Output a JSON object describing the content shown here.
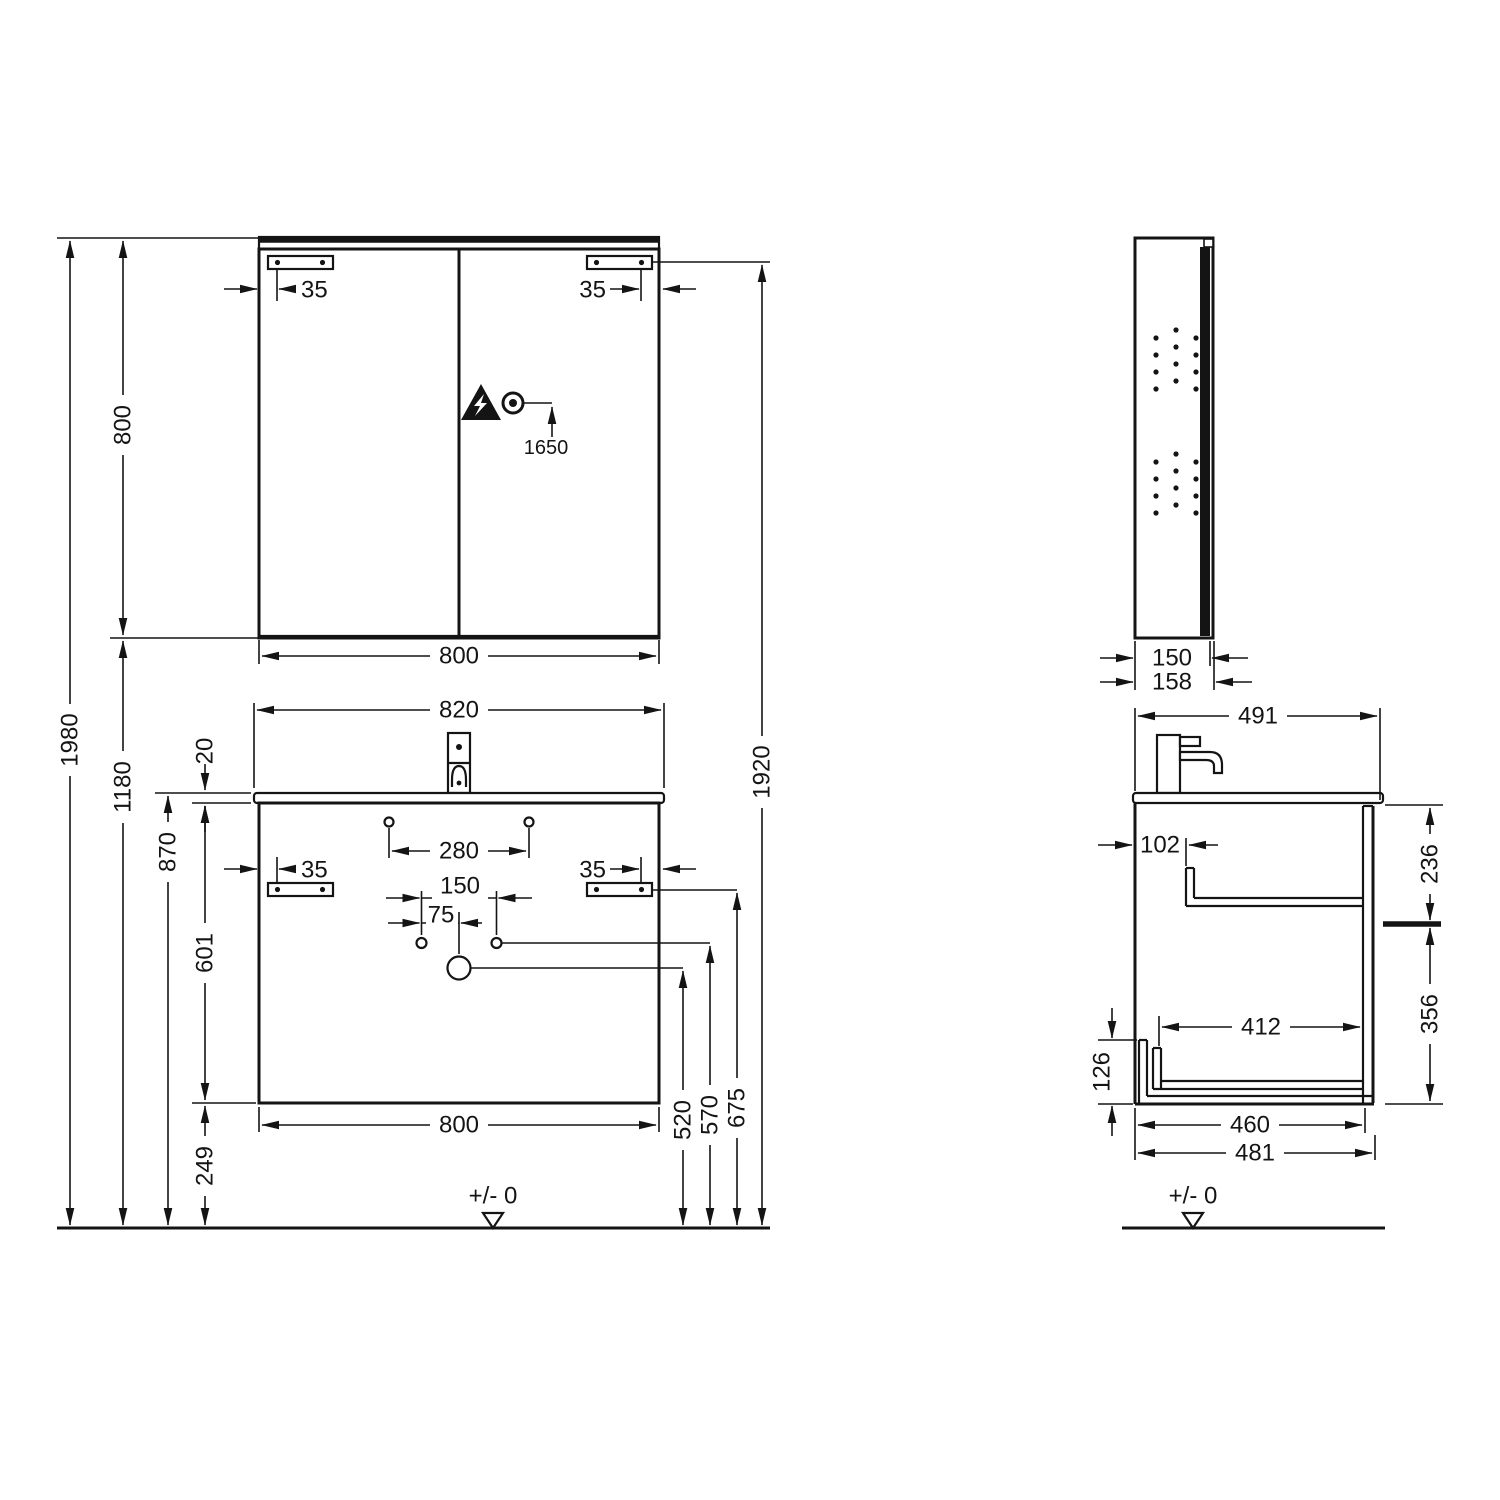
{
  "drawing": {
    "front_view": {
      "mirror": {
        "width": "800",
        "height": "800",
        "bracket_offset_left": "35",
        "bracket_offset_right": "35",
        "outlet_height": "1650"
      },
      "vanity": {
        "basin_width": "820",
        "basin_thickness": "20",
        "hole_spacing": "280",
        "bracket_offset_left": "35",
        "bracket_offset_right": "35",
        "tap_hole_spacing": "150",
        "drain_offset": "75",
        "cabinet_width": "800",
        "cabinet_height": "601"
      },
      "heights": {
        "total": "1980",
        "mirror_bottom": "1180",
        "basin_top": "870",
        "cabinet_bottom": "249",
        "drain": "520",
        "overflow": "570",
        "bracket": "675",
        "mirror_bracket": "1920"
      },
      "floor_label": "+/- 0"
    },
    "side_view": {
      "mirror": {
        "depth": "150",
        "depth_total": "158"
      },
      "vanity": {
        "depth": "491",
        "front_clearance": "102",
        "upper_height": "236",
        "lower_height": "356",
        "inner_depth": "412",
        "base_height": "126",
        "bottom_depth": "460",
        "bottom_total": "481"
      },
      "floor_label": "+/- 0"
    }
  }
}
